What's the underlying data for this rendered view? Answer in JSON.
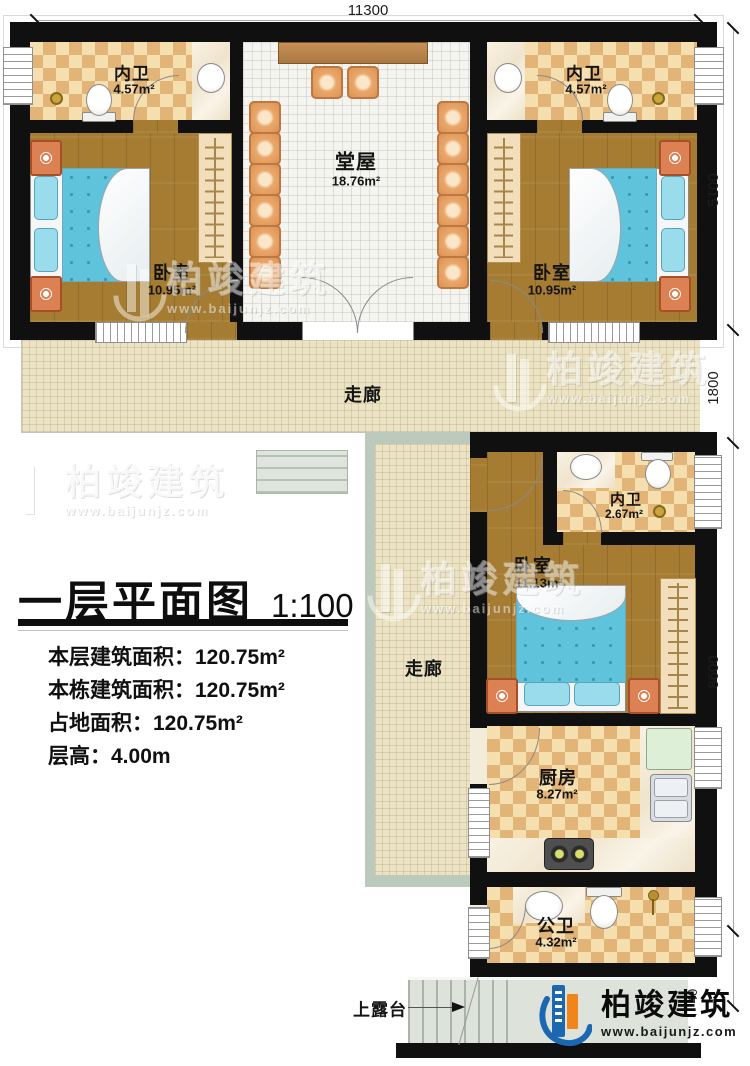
{
  "dimensions": {
    "top": "11300",
    "right": [
      "5100",
      "1800",
      "8600",
      "40"
    ]
  },
  "rooms": {
    "bath_left": {
      "name": "内卫",
      "area": "4.57m²"
    },
    "bath_right": {
      "name": "内卫",
      "area": "4.57m²"
    },
    "bedroom_left": {
      "name": "卧室",
      "area": "10.95m²"
    },
    "bedroom_right": {
      "name": "卧室",
      "area": "10.95m²"
    },
    "hall": {
      "name": "堂屋",
      "area": "18.76m²"
    },
    "corridor_upper": {
      "name": "走廊"
    },
    "corridor_side": {
      "name": "走廊"
    },
    "bath_mid": {
      "name": "内卫",
      "area": "2.67m²"
    },
    "bedroom_mid": {
      "name": "卧室",
      "area": "11.13m²"
    },
    "kitchen": {
      "name": "厨房",
      "area": "8.27m²"
    },
    "bath_public": {
      "name": "公卫",
      "area": "4.32m²"
    }
  },
  "annotations": {
    "terrace_stairs": "上露台"
  },
  "title_block": {
    "title": "一层平面图",
    "scale": "1:100",
    "lines": [
      "本层建筑面积：120.75m²",
      "本栋建筑面积：120.75m²",
      "占地面积：120.75m²",
      "层高：4.00m"
    ]
  },
  "branding": {
    "name": "柏竣建筑",
    "url": "www.baijunjz.com"
  },
  "watermark": {
    "text": "柏竣建筑",
    "url": "www.baijunjz.com"
  },
  "colors": {
    "wall": "#101010",
    "wood_floor": "#a57c31",
    "tile_light": "#f6dfae",
    "tile_dark": "#e3b477",
    "corridor_floor": "#ebe3c4",
    "hall_floor": "#f4f4f0",
    "bed_blue": "#5fc3dc",
    "chair_orange": "#e09a5f",
    "terrace_gray": "#dde2da",
    "logo_blue": "#1b67b1",
    "logo_orange": "#f08519"
  }
}
